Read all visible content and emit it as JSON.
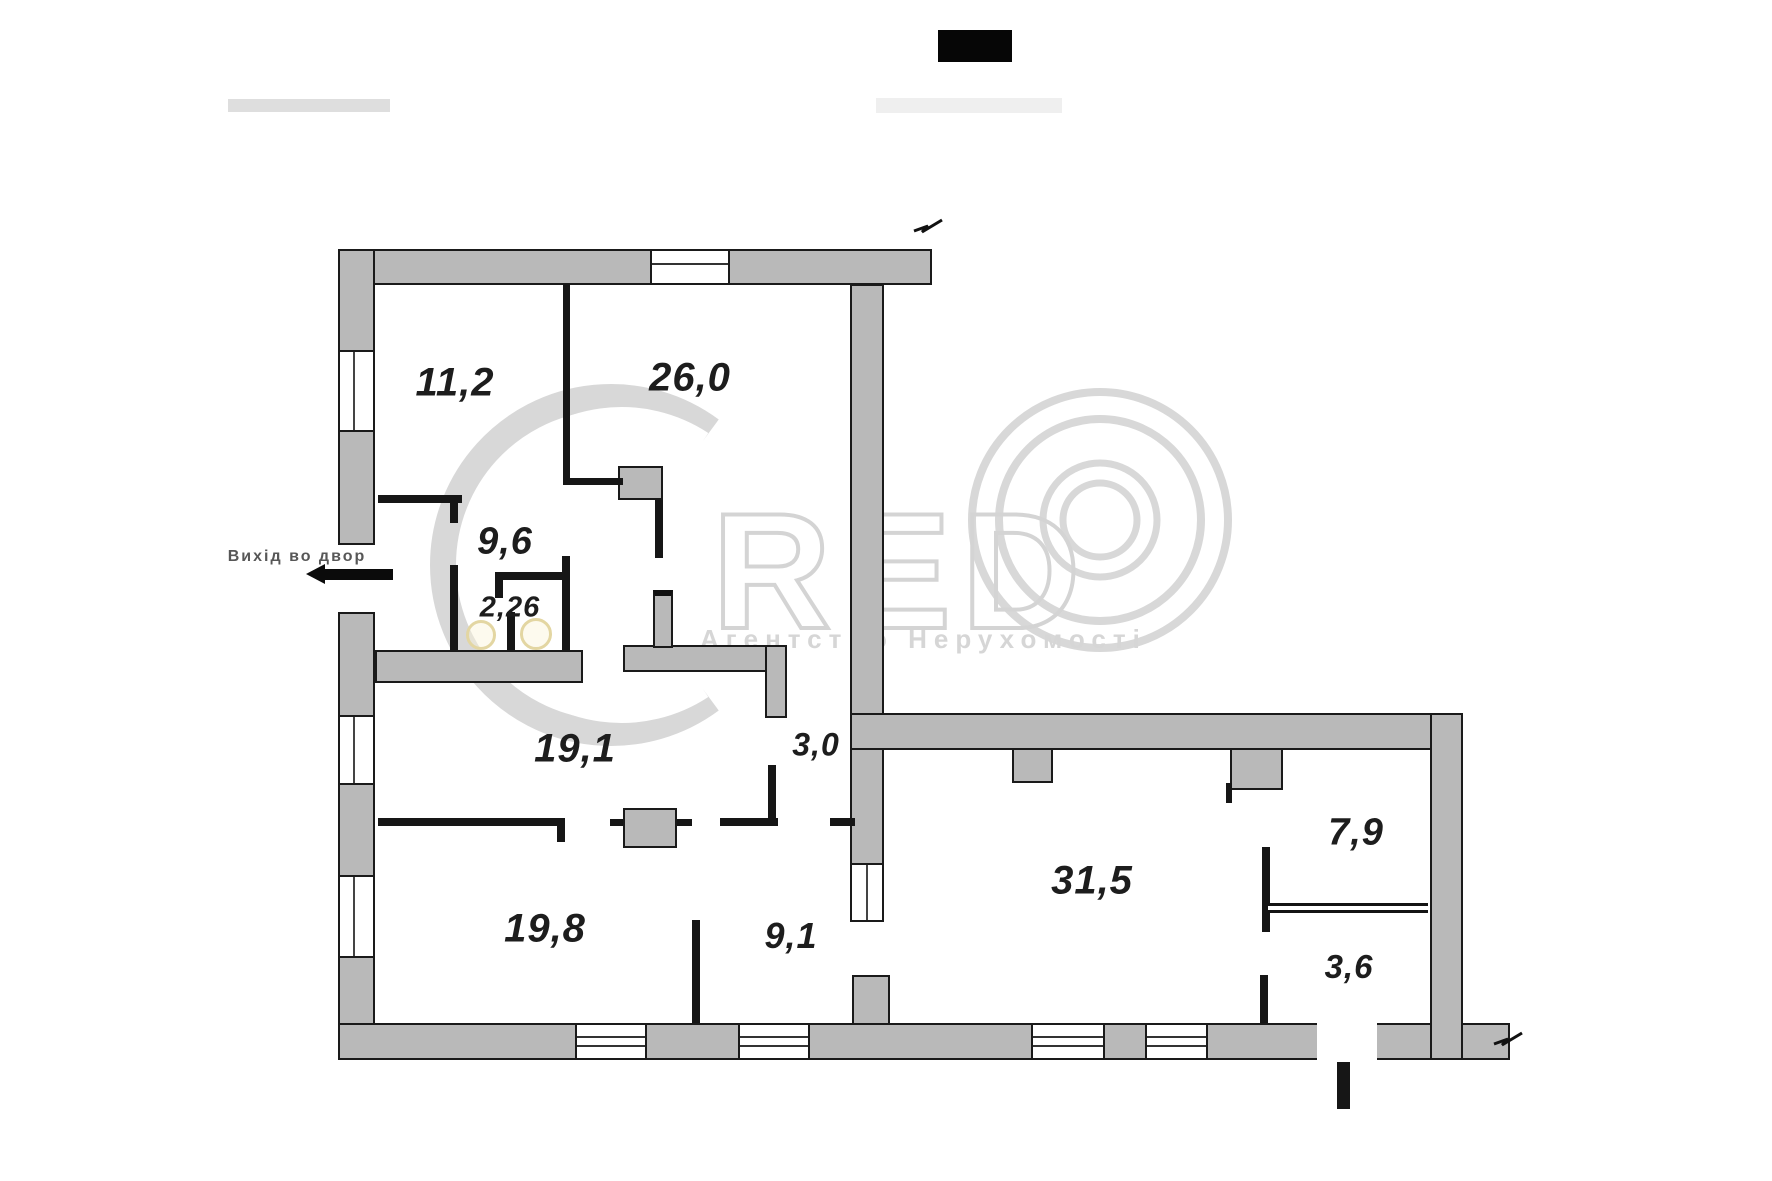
{
  "plan": {
    "rooms": [
      {
        "name": "room-top-left",
        "area": "11,2"
      },
      {
        "name": "room-top-right",
        "area": "26,0"
      },
      {
        "name": "hallway",
        "area": "9,6"
      },
      {
        "name": "wc",
        "area": "2,26"
      },
      {
        "name": "room-middle",
        "area": "19,1"
      },
      {
        "name": "corridor",
        "area": "3,0"
      },
      {
        "name": "room-bottom-left",
        "area": "19,8"
      },
      {
        "name": "room-bottom-mid",
        "area": "9,1"
      },
      {
        "name": "living-room",
        "area": "31,5"
      },
      {
        "name": "room-right-top",
        "area": "7,9"
      },
      {
        "name": "entry",
        "area": "3,6"
      }
    ],
    "exit_label": "Вихід во двор"
  },
  "watermark": {
    "letters": "RED",
    "agency": "Агентство Нерухомості"
  },
  "colors": {
    "wall_fill": "#b9b9b9",
    "wall_edge": "#1a1a1a",
    "watermark_gray": "#d8d8d8",
    "fixture_yellow": "#e3d6a2"
  }
}
